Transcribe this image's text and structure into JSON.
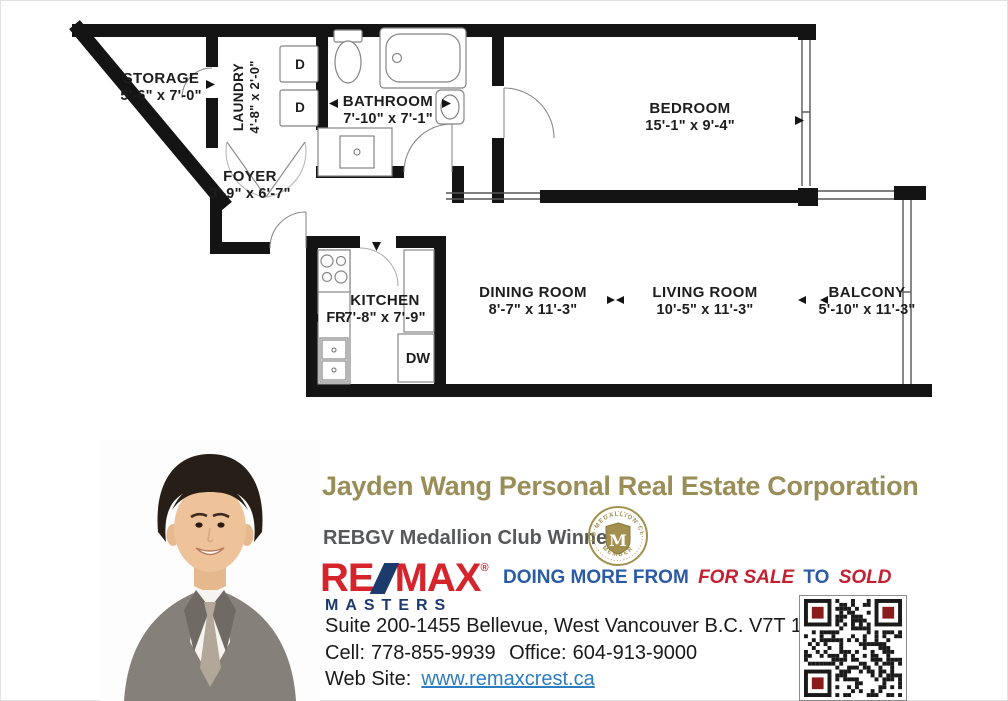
{
  "plan": {
    "rooms": [
      {
        "name": "STORAGE",
        "dims": "5'-6\" x 7'-0\""
      },
      {
        "name": "LAUNDRY",
        "dims": "4'-8\" x 2'-0\""
      },
      {
        "name": "BATHROOM",
        "dims": "7'-10\" x 7'-1\""
      },
      {
        "name": "BEDROOM",
        "dims": "15'-1\" x 9'-4\""
      },
      {
        "name": "FOYER",
        "dims": "3'-9\" x 6'-7\""
      },
      {
        "name": "KITCHEN",
        "dims": "7'-8\" x 7'-9\""
      },
      {
        "name": "DINING ROOM",
        "dims": "8'-7\" x 11'-3\""
      },
      {
        "name": "LIVING ROOM",
        "dims": "10'-5\" x 11'-3\""
      },
      {
        "name": "BALCONY",
        "dims": "5'-10\" x 11'-3\""
      }
    ],
    "appliances": {
      "fridge": "FR",
      "dishwasher": "DW",
      "dryer": "D"
    }
  },
  "agent": {
    "title": "Jayden Wang Personal Real Estate Corporation",
    "award": "REBGV Medallion Club Winner",
    "address": "Suite 200-1455 Bellevue, West Vancouver B.C. V7T 1C3",
    "cell_label": "Cell:",
    "cell": "778-855-9939",
    "office_label": "Office:",
    "office": "604-913-9000",
    "website_label": "Web Site:",
    "website": "www.remaxcrest.ca"
  },
  "brand": {
    "remax_re": "RE",
    "remax_max": "MAX",
    "remax_reg": "®",
    "remax_sub": "MASTERS",
    "slogan_1": "DOING MORE FROM",
    "slogan_2": "FOR SALE",
    "slogan_3": "TO",
    "slogan_4": "SOLD",
    "medallion_top": "MLS MEDALLION CLUB",
    "medallion_bottom": "MEMBER",
    "medallion_letter": "M"
  },
  "colors": {
    "title_gold": "#9a8e58",
    "award_gray": "#57585a",
    "remax_red": "#d6242c",
    "remax_navy": "#1d3a6d",
    "slogan_blue": "#2b5ba7",
    "slogan_red": "#c32032",
    "link_blue": "#2e7cc0",
    "medallion_gold": "#a3904f",
    "qr_red": "#8b1c1c",
    "wall_black": "#141414"
  }
}
